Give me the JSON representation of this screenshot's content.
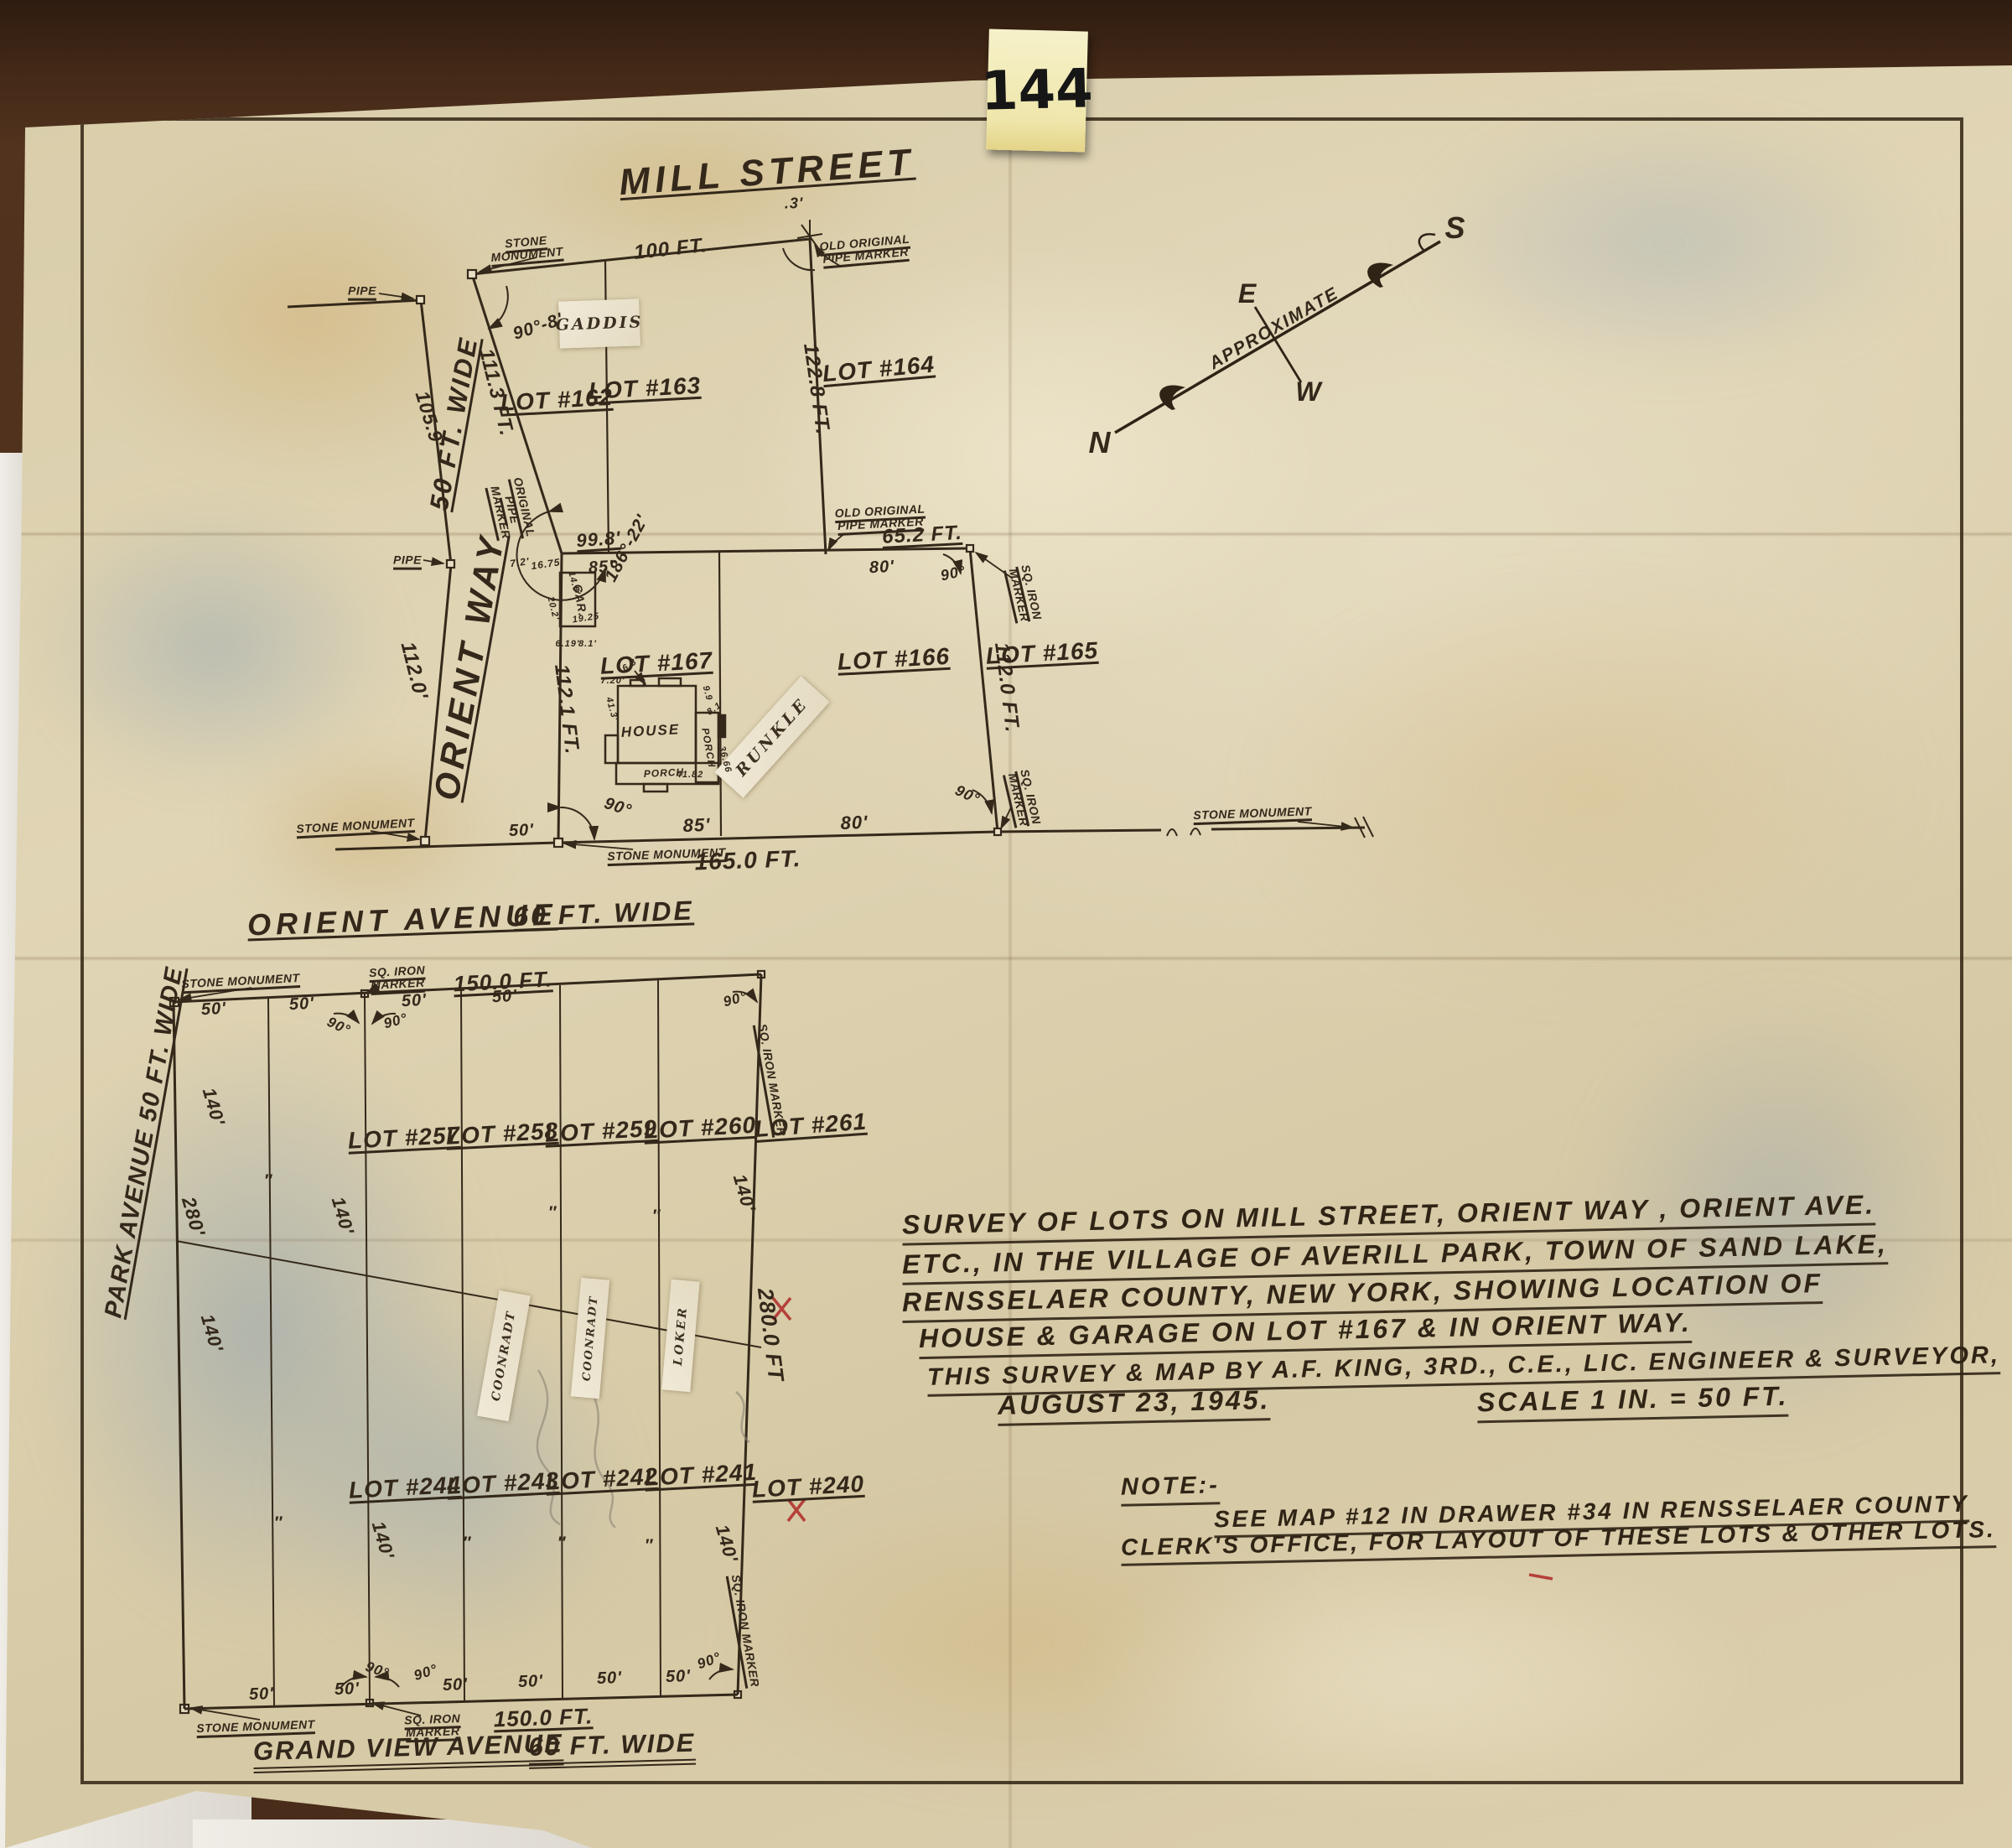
{
  "colors": {
    "ink": "#34291a",
    "paper": "#dbcfae",
    "carpet": "#462b19",
    "towel": "#e8e5df",
    "sticky_note": "#f1ecba",
    "red_mark": "#b5413a"
  },
  "photo": {
    "sticky_note_number": "144"
  },
  "streets": {
    "mill": "MILL STREET",
    "orient_way": "ORIENT WAY",
    "orient_way_width": "50 FT. WIDE",
    "orient_ave": "ORIENT AVENUE",
    "orient_ave_width": "60 FT. WIDE",
    "park_ave": "PARK AVENUE 50 FT. WIDE",
    "grand_view": "GRAND VIEW AVENUE",
    "grand_view_width": "60 FT. WIDE"
  },
  "compass": {
    "north": "N",
    "east": "E",
    "south": "S",
    "west": "W",
    "note": "APPROXIMATE"
  },
  "markers": {
    "stone_monument": "STONE MONUMENT",
    "pipe": "PIPE",
    "old_original_pipe_marker": "OLD ORIGINAL PIPE MARKER",
    "original_pipe_marker": "ORIGINAL PIPE MARKER",
    "sq_iron_marker": "SQ. IRON MARKER"
  },
  "upper_block": {
    "lots": {
      "lot162": "LOT #162",
      "lot163": "LOT #163",
      "lot164": "LOT #164",
      "lot165": "LOT #165",
      "lot166": "LOT #166",
      "lot167": "LOT #167"
    },
    "owners": {
      "gaddis": "GADDIS",
      "runkle": "RUNKLE"
    },
    "dims": {
      "mill_frontage": "100 FT.",
      "corner_offset": ".3'",
      "angle_90_8": "90°-8'",
      "west_105_9": "105.9'",
      "west_111_3": "111.3 FT.",
      "west_112_0": "112.0'",
      "east_122_8": "122.8 FT.",
      "angle_186_22": "186°-22'",
      "top_99_8": "99.8'",
      "top_85": "85'",
      "top_80": "80'",
      "top_65_2": "65.2 FT.",
      "angle_90": "90°",
      "side_112_0": "112.0 FT.",
      "side_112_1": "112.1 FT.",
      "bottom_85": "85'",
      "bottom_80": "80'",
      "bottom_165": "165.0 FT.",
      "bottom_50": "50'",
      "gar_7_2": "7.2'",
      "gar_16_75": "16.75"
    },
    "house": {
      "label": "HOUSE",
      "porch": "PORCH",
      "d_6_3": "6.3'",
      "d_7_20": "7.20'",
      "d_9_9": "9.9",
      "d_8_1": "8.1'",
      "d_41_82": "41.82",
      "d_36_66": "36.66",
      "d_41_3": "41.3'"
    },
    "garage": {
      "label": "GAR.",
      "d_14_5": "14.5'",
      "d_19_25": "19.25",
      "d_20_2": "20.2'",
      "d_6_19": "6.19'",
      "d_8_1": "8.1'"
    }
  },
  "lower_block": {
    "lots": {
      "lot240": "LOT #240",
      "lot241": "LOT #241",
      "lot242": "LOT #242",
      "lot243": "LOT #243",
      "lot244": "LOT #244",
      "lot257": "LOT #257",
      "lot258": "LOT #258",
      "lot259": "LOT #259",
      "lot260": "LOT #260",
      "lot261": "LOT #261"
    },
    "owners": {
      "coonradt": "COONRADT",
      "loker": "LOKER"
    },
    "dims": {
      "frontage_150": "150.0 FT.",
      "lot_width_50": "50'",
      "depth_140": "140'",
      "depth_280": "280'",
      "side_280": "280.0 FT",
      "angle_90": "90°",
      "ditto": "″"
    }
  },
  "title_block": {
    "line1": "SURVEY OF LOTS ON MILL STREET, ORIENT WAY , ORIENT AVE.",
    "line2": "ETC., IN THE VILLAGE OF AVERILL PARK, TOWN OF SAND LAKE,",
    "line3": "RENSSELAER COUNTY, NEW YORK, SHOWING LOCATION OF",
    "line4": "HOUSE & GARAGE ON LOT #167 & IN ORIENT WAY.",
    "line5": "THIS SURVEY & MAP BY A.F. KING, 3RD., C.E., LIC. ENGINEER & SURVEYOR,",
    "date": "AUGUST 23, 1945.",
    "scale": "SCALE 1 IN. = 50 FT."
  },
  "note_block": {
    "heading": "NOTE:-",
    "line1": "SEE MAP #12 IN DRAWER #34 IN RENSSELAER COUNTY",
    "line2": "CLERK'S OFFICE, FOR LAYOUT OF THESE LOTS & OTHER LOTS."
  }
}
